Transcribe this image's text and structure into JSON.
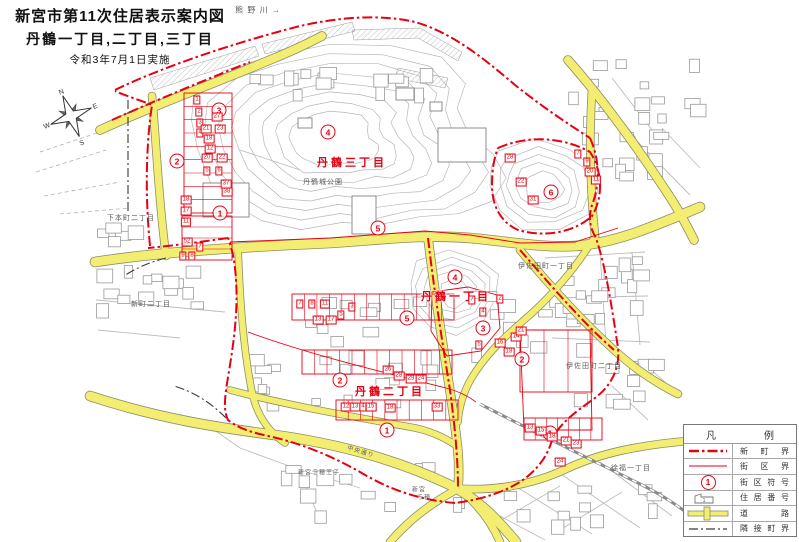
{
  "title": {
    "line1": "新宮市第11次住居表示案内図",
    "line2": "丹鶴一丁目,二丁目,三丁目",
    "line3": "令和3年7月1日実施"
  },
  "compass": {
    "n": "N",
    "e": "E",
    "s": "S",
    "w": "W"
  },
  "colors": {
    "boundary_red": "#e60012",
    "road_yellow": "#f3ee72",
    "contour_gray": "#b7b7b7"
  },
  "map": {
    "district_labels": [
      {
        "text": "丹鶴三丁目",
        "x": 352,
        "y": 162
      },
      {
        "text": "丹鶴一丁目",
        "x": 456,
        "y": 296
      },
      {
        "text": "丹鶴二丁目",
        "x": 390,
        "y": 391
      }
    ],
    "place_labels": [
      {
        "text": "熊 野 川 →",
        "x": 258,
        "y": 10,
        "size": 8
      },
      {
        "text": "丹鶴城公園",
        "x": 323,
        "y": 182,
        "size": 7
      },
      {
        "text": "下本町二丁目",
        "x": 131,
        "y": 218,
        "size": 7
      },
      {
        "text": "新町二丁目",
        "x": 151,
        "y": 304,
        "size": 7
      },
      {
        "text": "伊佐田町一丁目",
        "x": 546,
        "y": 266,
        "size": 7
      },
      {
        "text": "伊佐田町二丁目",
        "x": 594,
        "y": 366,
        "size": 7
      },
      {
        "text": "徐福一丁目",
        "x": 631,
        "y": 468,
        "size": 7
      },
      {
        "text": "中央通り",
        "x": 361,
        "y": 451,
        "size": 6,
        "rotate": 17
      },
      {
        "text": "新宮千穂王子",
        "x": 319,
        "y": 472,
        "size": 6
      },
      {
        "text": "新宮",
        "x": 419,
        "y": 489,
        "size": 6
      },
      {
        "text": "千穂",
        "x": 424,
        "y": 497,
        "size": 6
      }
    ],
    "block_symbols": [
      {
        "n": "3",
        "x": 219,
        "y": 110
      },
      {
        "n": "2",
        "x": 177,
        "y": 161
      },
      {
        "n": "1",
        "x": 220,
        "y": 213
      },
      {
        "n": "4",
        "x": 328,
        "y": 132
      },
      {
        "n": "5",
        "x": 378,
        "y": 228
      },
      {
        "n": "4",
        "x": 455,
        "y": 277
      },
      {
        "n": "5",
        "x": 407,
        "y": 318
      },
      {
        "n": "3",
        "x": 483,
        "y": 328
      },
      {
        "n": "2",
        "x": 522,
        "y": 359
      },
      {
        "n": "6",
        "x": 551,
        "y": 192
      },
      {
        "n": "2",
        "x": 340,
        "y": 380
      },
      {
        "n": "1",
        "x": 387,
        "y": 430
      },
      {
        "n": "1",
        "x": 550,
        "y": 433
      }
    ],
    "house_numbers": [
      {
        "n": "1",
        "x": 197,
        "y": 100
      },
      {
        "n": "2",
        "x": 199,
        "y": 112
      },
      {
        "n": "3",
        "x": 200,
        "y": 123
      },
      {
        "n": "4",
        "x": 200,
        "y": 133
      },
      {
        "n": "27",
        "x": 217,
        "y": 117
      },
      {
        "n": "21",
        "x": 206,
        "y": 129
      },
      {
        "n": "23",
        "x": 220,
        "y": 129
      },
      {
        "n": "18",
        "x": 209,
        "y": 139
      },
      {
        "n": "12",
        "x": 210,
        "y": 149
      },
      {
        "n": "20",
        "x": 207,
        "y": 158
      },
      {
        "n": "22",
        "x": 222,
        "y": 158
      },
      {
        "n": "5",
        "x": 207,
        "y": 171
      },
      {
        "n": "6",
        "x": 219,
        "y": 171
      },
      {
        "n": "37",
        "x": 226,
        "y": 184
      },
      {
        "n": "38",
        "x": 227,
        "y": 192
      },
      {
        "n": "18",
        "x": 186,
        "y": 200
      },
      {
        "n": "17",
        "x": 186,
        "y": 211
      },
      {
        "n": "11",
        "x": 186,
        "y": 222
      },
      {
        "n": "52",
        "x": 187,
        "y": 242
      },
      {
        "n": "7",
        "x": 200,
        "y": 247
      },
      {
        "n": "9",
        "x": 183,
        "y": 256
      },
      {
        "n": "8",
        "x": 192,
        "y": 256
      },
      {
        "n": "7",
        "x": 300,
        "y": 304
      },
      {
        "n": "8",
        "x": 312,
        "y": 304
      },
      {
        "n": "11",
        "x": 325,
        "y": 304
      },
      {
        "n": "13",
        "x": 318,
        "y": 320
      },
      {
        "n": "17",
        "x": 331,
        "y": 320
      },
      {
        "n": "5",
        "x": 341,
        "y": 315
      },
      {
        "n": "3",
        "x": 352,
        "y": 307
      },
      {
        "n": "26",
        "x": 388,
        "y": 370
      },
      {
        "n": "28",
        "x": 399,
        "y": 376
      },
      {
        "n": "29",
        "x": 411,
        "y": 379
      },
      {
        "n": "24",
        "x": 421,
        "y": 379
      },
      {
        "n": "12",
        "x": 346,
        "y": 407
      },
      {
        "n": "13",
        "x": 355,
        "y": 407
      },
      {
        "n": "4",
        "x": 363,
        "y": 407
      },
      {
        "n": "15",
        "x": 371,
        "y": 407
      },
      {
        "n": "18",
        "x": 390,
        "y": 408
      },
      {
        "n": "33",
        "x": 437,
        "y": 407
      },
      {
        "n": "2",
        "x": 500,
        "y": 299
      },
      {
        "n": "4",
        "x": 483,
        "y": 312
      },
      {
        "n": "7",
        "x": 472,
        "y": 300
      },
      {
        "n": "5",
        "x": 479,
        "y": 345
      },
      {
        "n": "16",
        "x": 500,
        "y": 343
      },
      {
        "n": "14",
        "x": 516,
        "y": 337
      },
      {
        "n": "18",
        "x": 509,
        "y": 352
      },
      {
        "n": "21",
        "x": 521,
        "y": 331
      },
      {
        "n": "28",
        "x": 510,
        "y": 158
      },
      {
        "n": "22",
        "x": 521,
        "y": 182
      },
      {
        "n": "31",
        "x": 533,
        "y": 200
      },
      {
        "n": "7",
        "x": 578,
        "y": 154
      },
      {
        "n": "9",
        "x": 587,
        "y": 162
      },
      {
        "n": "20",
        "x": 590,
        "y": 172
      },
      {
        "n": "11",
        "x": 596,
        "y": 180
      },
      {
        "n": "13",
        "x": 530,
        "y": 428
      },
      {
        "n": "15",
        "x": 541,
        "y": 431
      },
      {
        "n": "18",
        "x": 552,
        "y": 437
      },
      {
        "n": "21",
        "x": 566,
        "y": 441
      },
      {
        "n": "23",
        "x": 576,
        "y": 444
      },
      {
        "n": "24",
        "x": 560,
        "y": 462
      }
    ]
  },
  "legend": {
    "title": "凡例",
    "sample_number": "1",
    "house_sample": "1",
    "rows": [
      {
        "label": "新町界"
      },
      {
        "label": "街区界"
      },
      {
        "label": "街区符号"
      },
      {
        "label": "住居番号"
      },
      {
        "label": "道路"
      },
      {
        "label": "隣接町界"
      }
    ]
  }
}
